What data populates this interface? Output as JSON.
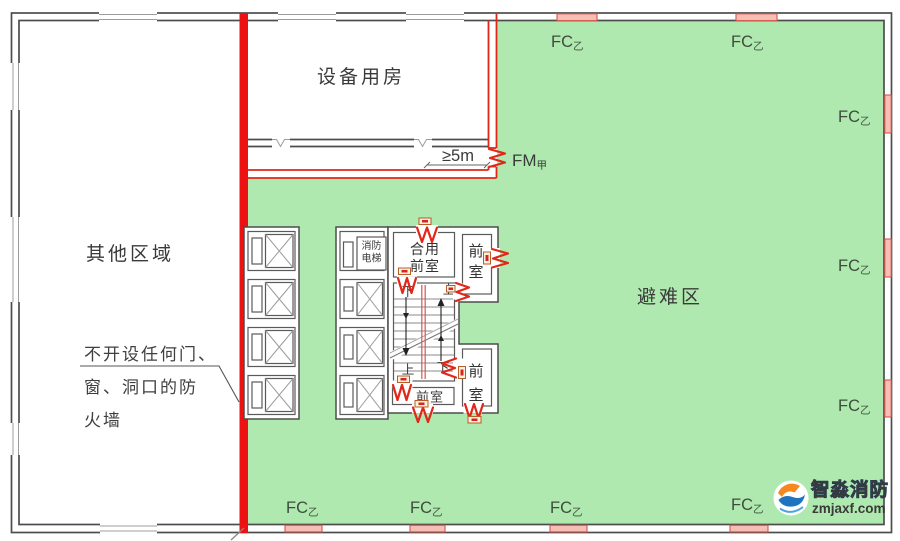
{
  "diagram": {
    "regions": {
      "equipment_room": "设备用房",
      "other_area": "其他区域",
      "refuge_area": "避难区"
    },
    "firewall_note": {
      "line1": "不开设任何门、",
      "line2": "窗、洞口的防",
      "line3": "火墙"
    },
    "dimension": {
      "min_distance": "≥5m"
    },
    "door_label": {
      "code": "FM",
      "class": "甲"
    },
    "window_label": {
      "code": "FC",
      "class": "乙"
    },
    "core": {
      "fire_elevator_line1": "消防",
      "fire_elevator_line2": "电梯",
      "shared_vestibule_line1": "合用",
      "shared_vestibule_line2": "前室",
      "vestibule": "前室",
      "vestibule_char_front": "前",
      "vestibule_char_room": "室",
      "stair_up": "上",
      "stair_down": "下"
    },
    "watermark": {
      "brand": "智淼消防",
      "domain": "zmjaxf.com"
    },
    "colors": {
      "refuge_green": "#afe9af",
      "fire_red": "#ed1111",
      "fire_window_pink": "#f6beb5",
      "wall_gray": "#4d4d4d",
      "door_red": "#e02718"
    }
  }
}
